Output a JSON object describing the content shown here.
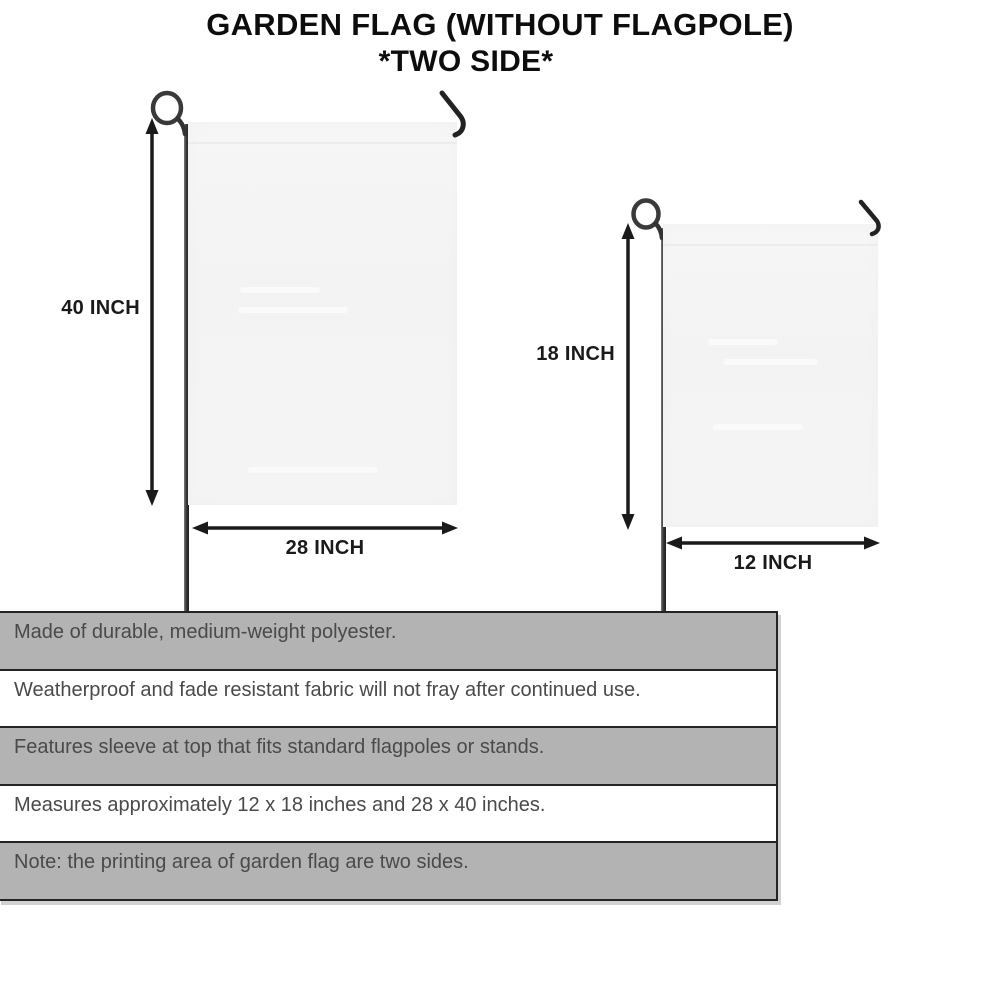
{
  "title": {
    "line1": "GARDEN FLAG (WITHOUT FLAGPOLE)",
    "line2": "*TWO SIDE*"
  },
  "large_flag": {
    "height_label": "40 INCH",
    "width_label": "28 INCH"
  },
  "small_flag": {
    "height_label": "18 INCH",
    "width_label": "12 INCH"
  },
  "spec_rows": [
    {
      "text": "Made of durable, medium-weight polyester.",
      "shaded": true
    },
    {
      "text": "Weatherproof and fade resistant fabric will not fray after continued use.",
      "shaded": false
    },
    {
      "text": "Features sleeve at top that fits standard flagpoles or stands.",
      "shaded": true
    },
    {
      "text": "Measures approximately 12 x 18 inches and 28 x 40 inches.",
      "shaded": false
    },
    {
      "text": "Note: the printing area of garden flag are two sides.",
      "shaded": true
    }
  ],
  "colors": {
    "ink": "#0d0d0d",
    "arrow": "#1a1a1a",
    "border": "#242424",
    "row_shaded": "#b3b3b3",
    "body_text": "#4a4a4a",
    "flag_fill": "#f4f4f4",
    "pole": "#2e2e2e"
  }
}
